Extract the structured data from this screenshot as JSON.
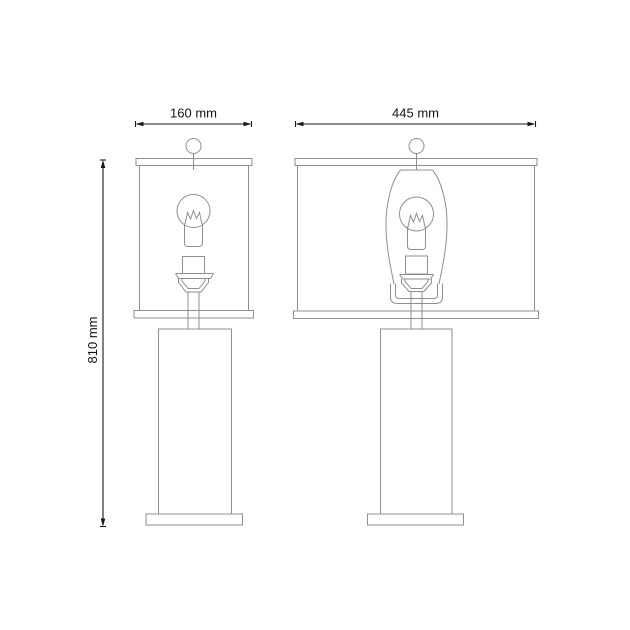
{
  "page": {
    "background_color": "#ffffff"
  },
  "diagram": {
    "type": "product-dimension-line-drawing",
    "subject": "table lamp shown in two elevation views",
    "stroke_color": "#8f8f8f",
    "dimension_color": "#1a1a1a",
    "labels": {
      "front_width": "160 mm",
      "side_width": "445 mm",
      "height": "810 mm"
    },
    "views": [
      {
        "id": "front-view",
        "width_label": "160 mm"
      },
      {
        "id": "side-view",
        "width_label": "445 mm"
      }
    ],
    "parts": [
      "finial",
      "shade-top-rim",
      "shade",
      "shade-bottom-rim",
      "bulb",
      "filament",
      "bulb-base",
      "socket",
      "socket-flange",
      "socket-cup",
      "harp",
      "harp-bracket",
      "stem",
      "cylindrical-body",
      "base-plate"
    ]
  }
}
